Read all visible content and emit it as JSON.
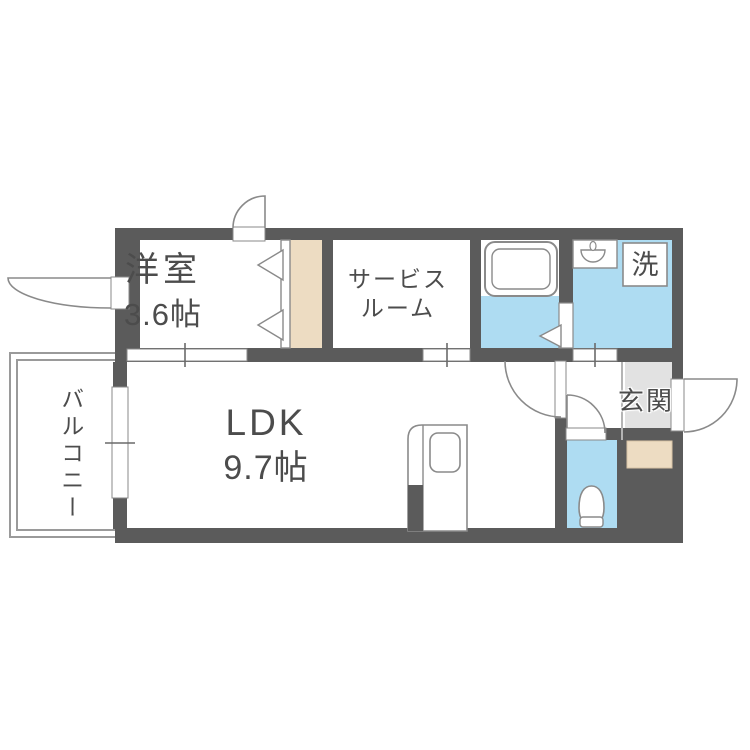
{
  "plan": {
    "rooms": {
      "western_room": {
        "label": "洋室",
        "size": "3.6帖"
      },
      "service_room": {
        "label_line1": "サービス",
        "label_line2": "ルーム"
      },
      "ldk": {
        "label": "LDK",
        "size": "9.7帖"
      },
      "balcony": {
        "label": "バルコニー"
      },
      "entrance": {
        "label": "玄関"
      },
      "laundry": {
        "label": "洗"
      }
    },
    "icons": [
      "bathtub-icon",
      "sink-icon",
      "toilet-icon",
      "kitchen-counter-icon",
      "closet-folding-door-icon",
      "bath-folding-door-icon",
      "door-swing-icon",
      "window-swing-icon",
      "opening-tick-icon"
    ]
  },
  "colors": {
    "wall": "#5b5b5b",
    "water": "#aedcf2",
    "wood": "#eddcc2",
    "entrance_floor": "#e2e2e2",
    "outline": "#8a8a8a",
    "text": "#4c4c4c",
    "rail": "#9a9a9a"
  }
}
